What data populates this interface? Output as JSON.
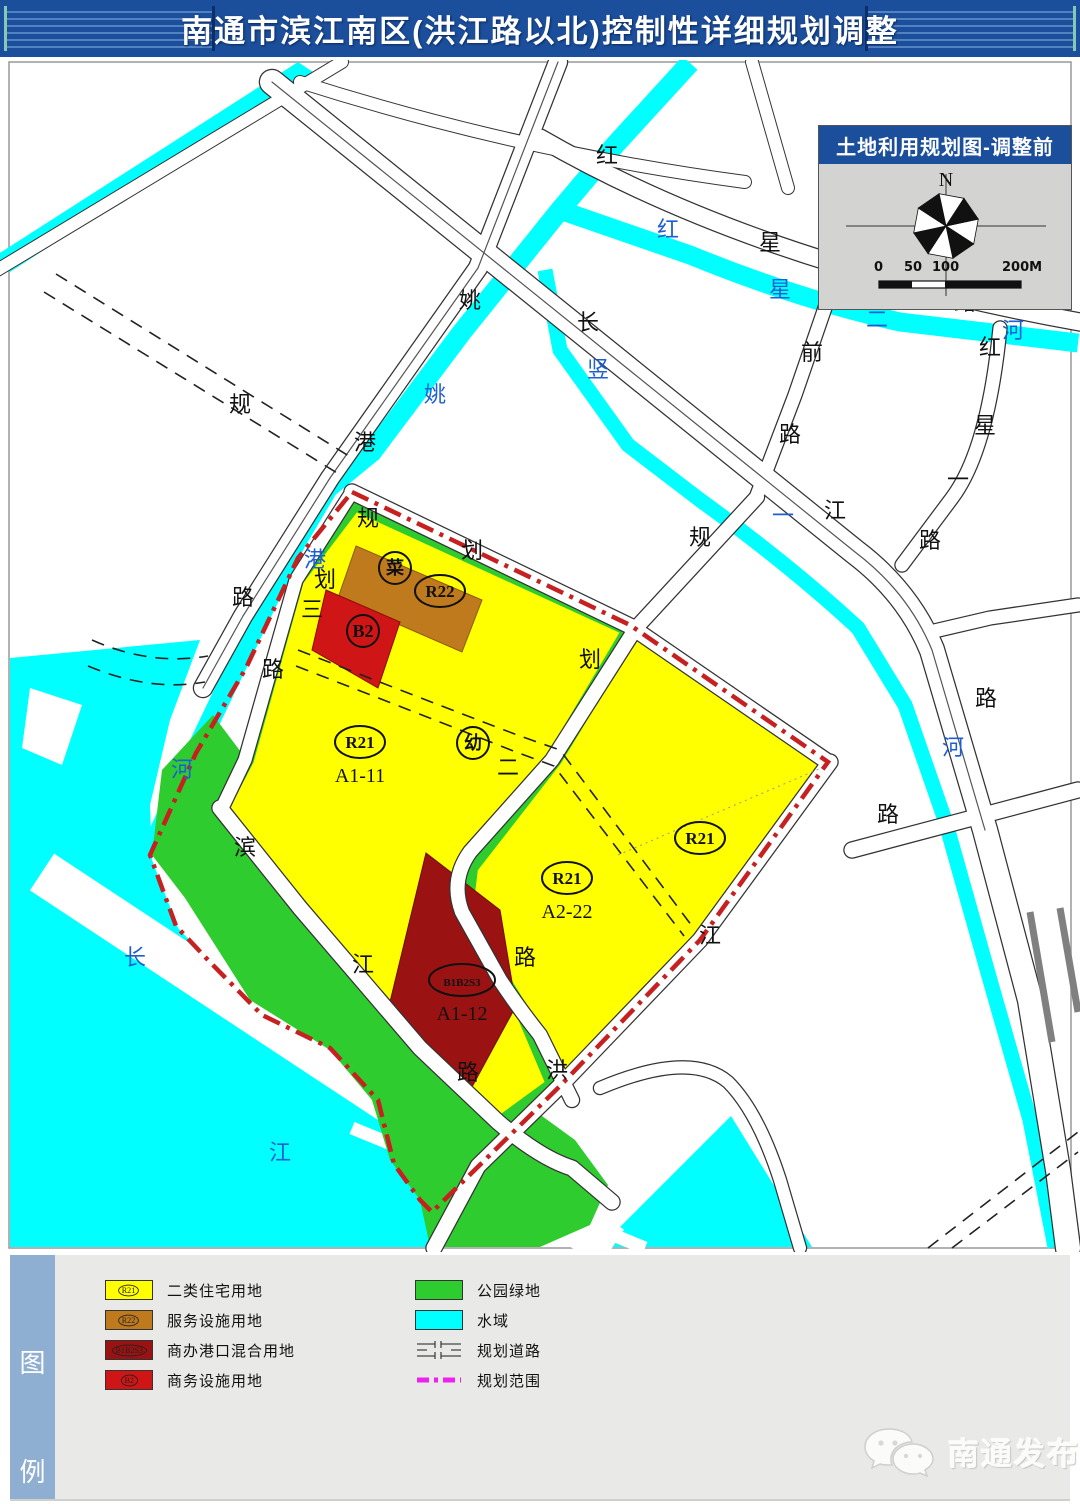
{
  "header": {
    "title": "南通市滨江南区(洪江路以北)控制性详细规划调整"
  },
  "inset": {
    "title": "土地利用规划图-调整前",
    "north_label": "N",
    "scale_ticks": [
      "0",
      "50",
      "100",
      "200M"
    ]
  },
  "map": {
    "colors": {
      "water": "#00ffff",
      "park_green": "#2fcc2f",
      "residential_yellow": "#ffff00",
      "service_orange": "#c07a1e",
      "mixed_darkred": "#9b1212",
      "business_red": "#cf1515",
      "boundary_red": "#c62020",
      "road_label_black": "#111111",
      "water_label_blue": "#1d5fd2"
    },
    "parcels": [
      {
        "code": "菜",
        "x": 395,
        "y": 508,
        "w": 1
      },
      {
        "code": "R22",
        "x": 440,
        "y": 531,
        "w": 2
      },
      {
        "code": "B2",
        "x": 363,
        "y": 571,
        "w": 1
      },
      {
        "code": "R21",
        "sub": "A1-11",
        "x": 360,
        "y": 682,
        "w": 2
      },
      {
        "code": "幼",
        "x": 473,
        "y": 683,
        "w": 1
      },
      {
        "code": "R21",
        "x": 700,
        "y": 778,
        "w": 2
      },
      {
        "code": "R21",
        "sub": "A2-22",
        "x": 567,
        "y": 818,
        "w": 2
      },
      {
        "code": "B1B2S3",
        "sub": "A1-12",
        "x": 462,
        "y": 920,
        "w": 3
      }
    ],
    "road_labels": [
      {
        "t": "红",
        "x": 607,
        "y": 103
      },
      {
        "t": "星",
        "x": 770,
        "y": 190
      },
      {
        "t": "庵",
        "x": 850,
        "y": 203
      },
      {
        "t": "路",
        "x": 965,
        "y": 250
      },
      {
        "t": "姚",
        "x": 470,
        "y": 248
      },
      {
        "t": "长",
        "x": 588,
        "y": 270
      },
      {
        "t": "前",
        "x": 812,
        "y": 300
      },
      {
        "t": "红",
        "x": 990,
        "y": 295
      },
      {
        "t": "规",
        "x": 240,
        "y": 352
      },
      {
        "t": "港",
        "x": 365,
        "y": 390
      },
      {
        "t": "星",
        "x": 985,
        "y": 373
      },
      {
        "t": "路",
        "x": 790,
        "y": 382
      },
      {
        "t": "一",
        "x": 958,
        "y": 427
      },
      {
        "t": "江",
        "x": 835,
        "y": 458
      },
      {
        "t": "路",
        "x": 930,
        "y": 488
      },
      {
        "t": "规",
        "x": 700,
        "y": 485
      },
      {
        "t": "规",
        "x": 368,
        "y": 466
      },
      {
        "t": "划",
        "x": 472,
        "y": 498
      },
      {
        "t": "划",
        "x": 325,
        "y": 527
      },
      {
        "t": "路",
        "x": 243,
        "y": 545
      },
      {
        "t": "三",
        "x": 312,
        "y": 557
      },
      {
        "t": "划",
        "x": 590,
        "y": 607
      },
      {
        "t": "路",
        "x": 273,
        "y": 617
      },
      {
        "t": "路",
        "x": 986,
        "y": 646
      },
      {
        "t": "二",
        "x": 508,
        "y": 715
      },
      {
        "t": "路",
        "x": 888,
        "y": 762
      },
      {
        "t": "滨",
        "x": 245,
        "y": 795
      },
      {
        "t": "江",
        "x": 710,
        "y": 883
      },
      {
        "t": "路",
        "x": 525,
        "y": 905
      },
      {
        "t": "江",
        "x": 363,
        "y": 912
      },
      {
        "t": "洪",
        "x": 557,
        "y": 1018
      },
      {
        "t": "路",
        "x": 468,
        "y": 1020
      }
    ],
    "water_labels": [
      {
        "t": "红",
        "x": 668,
        "y": 177
      },
      {
        "t": "星",
        "x": 780,
        "y": 237
      },
      {
        "t": "二",
        "x": 877,
        "y": 267
      },
      {
        "t": "河",
        "x": 1013,
        "y": 278
      },
      {
        "t": "竖",
        "x": 598,
        "y": 317
      },
      {
        "t": "姚",
        "x": 435,
        "y": 342
      },
      {
        "t": "一",
        "x": 783,
        "y": 463
      },
      {
        "t": "港",
        "x": 315,
        "y": 507
      },
      {
        "t": "河",
        "x": 953,
        "y": 695
      },
      {
        "t": "河",
        "x": 182,
        "y": 717
      },
      {
        "t": "长",
        "x": 135,
        "y": 905
      },
      {
        "t": "江",
        "x": 280,
        "y": 1100
      }
    ]
  },
  "legend": {
    "sidebar_chars": [
      "图",
      "例"
    ],
    "items": [
      {
        "swatch": "color",
        "color": "#ffff00",
        "symbol": "R21",
        "label": "二类住宅用地"
      },
      {
        "swatch": "color",
        "color": "#c07a1e",
        "symbol": "R22",
        "label": "服务设施用地"
      },
      {
        "swatch": "color",
        "color": "#9b1212",
        "symbol": "B1B2S3",
        "label": "商办港口混合用地"
      },
      {
        "swatch": "color",
        "color": "#cf1515",
        "symbol": "B2",
        "label": "商务设施用地"
      },
      {
        "swatch": "color",
        "color": "#2fcc2f",
        "symbol": "",
        "label": "公园绿地"
      },
      {
        "swatch": "color",
        "color": "#00ffff",
        "symbol": "",
        "label": "水域"
      },
      {
        "swatch": "road",
        "color": "",
        "symbol": "",
        "label": "规划道路"
      },
      {
        "swatch": "boundary",
        "color": "#ee22ee",
        "symbol": "",
        "label": "规划范围"
      }
    ]
  },
  "watermark": {
    "name": "南通发布"
  }
}
